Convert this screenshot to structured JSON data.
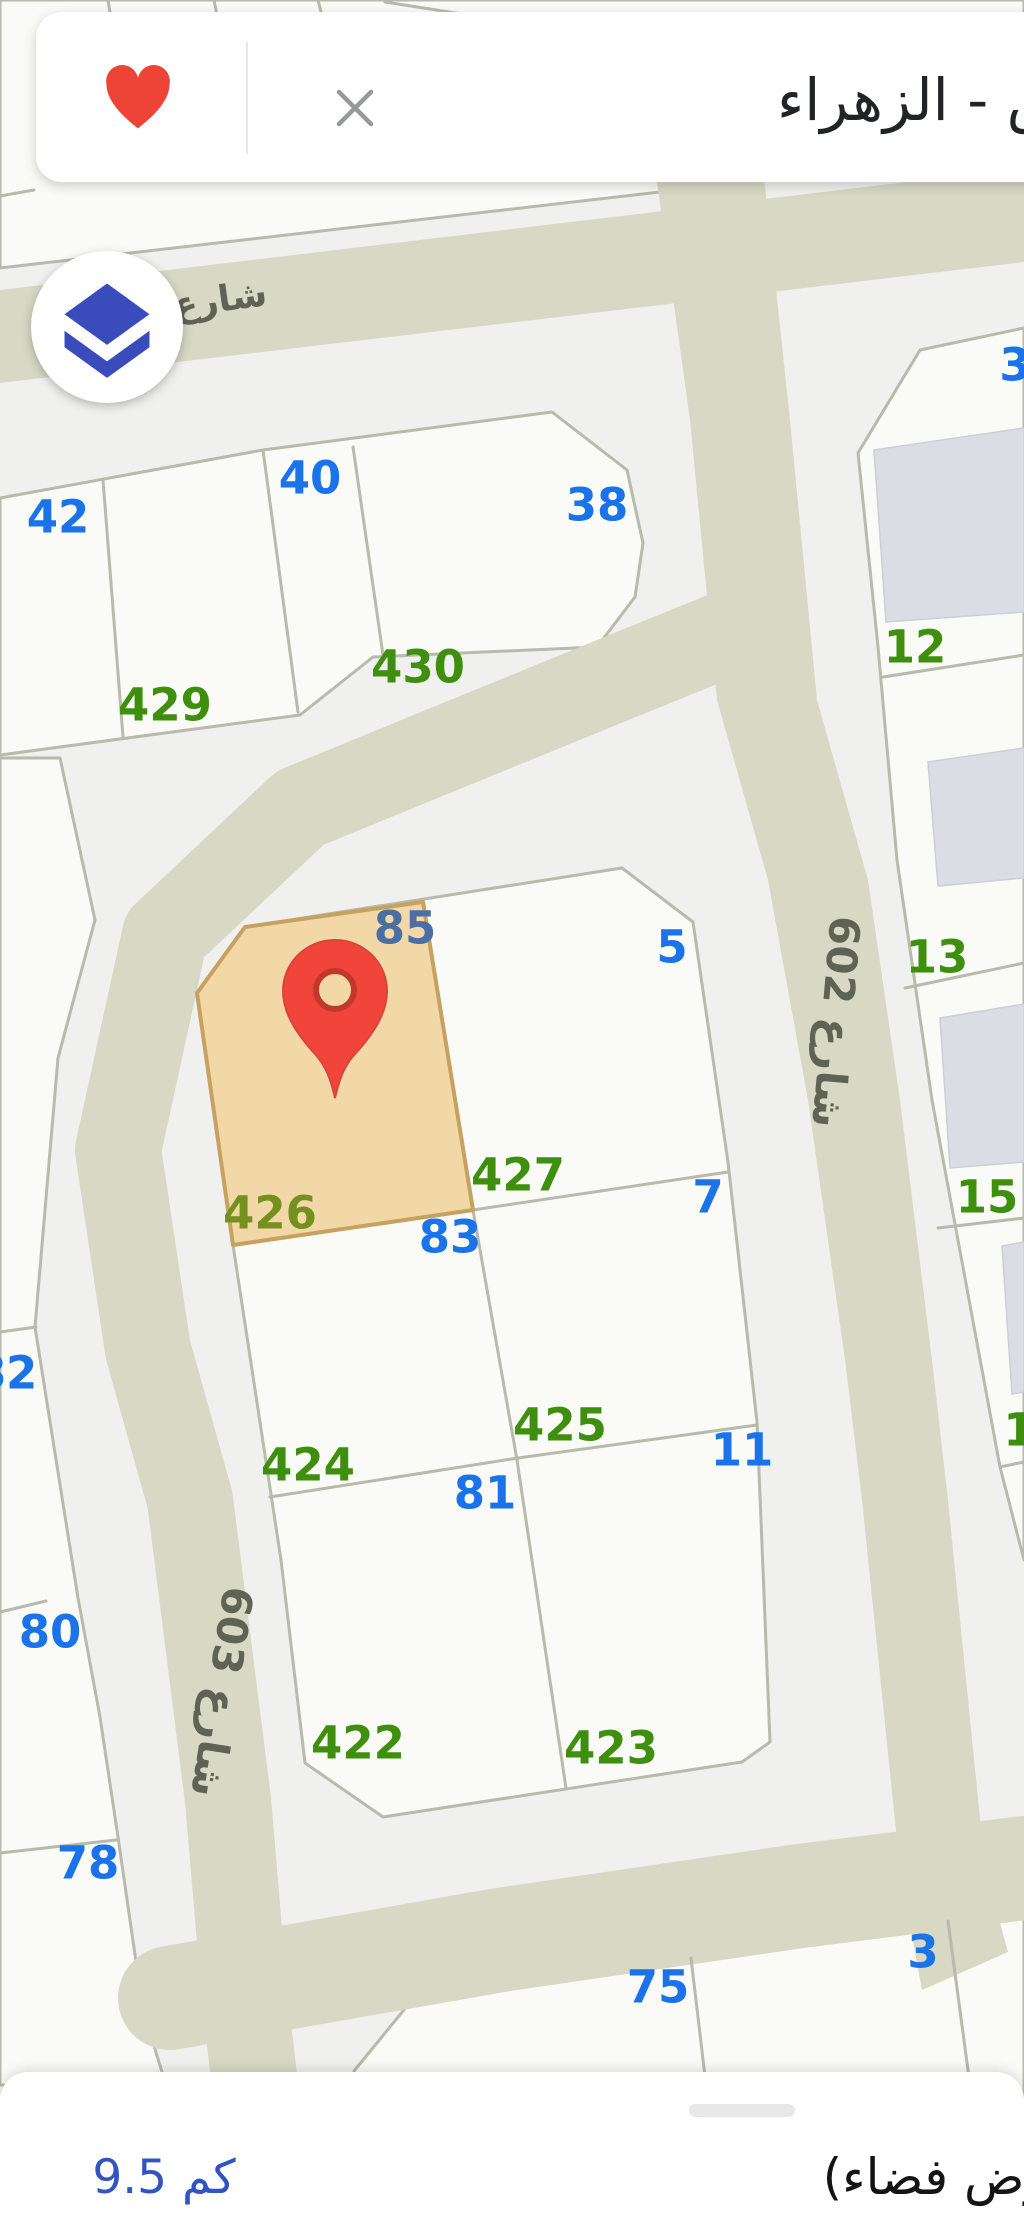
{
  "header": {
    "title_full": "الرياض - الزهراء",
    "title_visible": "- الزهراء",
    "favorite_icon": "heart-icon",
    "close_icon": "x-icon"
  },
  "controls": {
    "layers_icon": "layers-icon"
  },
  "sheet": {
    "distance": "9.5 كم",
    "note_full": "(أرض فضاء)",
    "note_visible": "ض فضاء)"
  },
  "colors": {
    "bg": "#f0f1ee",
    "parcel": "#fafaf7",
    "parcel_border": "#b7baac",
    "street": "#d7d9c5",
    "street_label": "#5f6354",
    "building": "#dcdde4",
    "building_border": "#cdced6",
    "blue": "#1a73e8",
    "green": "#3f8f0f",
    "muted_blue": "#4a6fa5",
    "muted_green": "#74901f",
    "orange": "#f3d8a7",
    "orange_border": "#c7a160",
    "pin_red": "#f1453b",
    "pin_ring": "#c2392b",
    "heart_red": "#ee4337",
    "close_gray": "#97999e",
    "layers_blue": "#3a4cbb",
    "distance_blue": "#3253c2"
  },
  "map": {
    "street_labels": [
      {
        "text": "شارع",
        "x": 220,
        "y": 300,
        "rot": -8,
        "size": 36
      },
      {
        "text": "شارع 602",
        "x": 836,
        "y": 1022,
        "rot": 95,
        "size": 42
      },
      {
        "text": "شارع 603",
        "x": 222,
        "y": 1692,
        "rot": 99,
        "size": 42
      }
    ],
    "parcel_labels": [
      {
        "t": "42",
        "x": 58,
        "y": 517,
        "c": "blue"
      },
      {
        "t": "40",
        "x": 310,
        "y": 478,
        "c": "blue"
      },
      {
        "t": "38",
        "x": 597,
        "y": 505,
        "c": "blue"
      },
      {
        "t": "3",
        "x": 1015,
        "y": 365,
        "c": "blue"
      },
      {
        "t": "429",
        "x": 165,
        "y": 705,
        "c": "green"
      },
      {
        "t": "430",
        "x": 418,
        "y": 667,
        "c": "green"
      },
      {
        "t": "12",
        "x": 915,
        "y": 647,
        "c": "green"
      },
      {
        "t": "85",
        "x": 405,
        "y": 928,
        "c": "muted_blue"
      },
      {
        "t": "5",
        "x": 672,
        "y": 947,
        "c": "blue"
      },
      {
        "t": "13",
        "x": 937,
        "y": 957,
        "c": "green"
      },
      {
        "t": "427",
        "x": 518,
        "y": 1175,
        "c": "green"
      },
      {
        "t": "7",
        "x": 708,
        "y": 1197,
        "c": "blue"
      },
      {
        "t": "15",
        "x": 987,
        "y": 1197,
        "c": "green"
      },
      {
        "t": "426",
        "x": 270,
        "y": 1213,
        "c": "muted_green"
      },
      {
        "t": "83",
        "x": 450,
        "y": 1237,
        "c": "blue"
      },
      {
        "t": "82",
        "x": 6,
        "y": 1373,
        "c": "blue"
      },
      {
        "t": "425",
        "x": 560,
        "y": 1425,
        "c": "green"
      },
      {
        "t": "1",
        "x": 1019,
        "y": 1430,
        "c": "green"
      },
      {
        "t": "11",
        "x": 742,
        "y": 1450,
        "c": "blue"
      },
      {
        "t": "424",
        "x": 308,
        "y": 1465,
        "c": "green"
      },
      {
        "t": "81",
        "x": 485,
        "y": 1493,
        "c": "blue"
      },
      {
        "t": "80",
        "x": 50,
        "y": 1632,
        "c": "blue"
      },
      {
        "t": "422",
        "x": 358,
        "y": 1743,
        "c": "green"
      },
      {
        "t": "423",
        "x": 611,
        "y": 1748,
        "c": "green"
      },
      {
        "t": "78",
        "x": 88,
        "y": 1863,
        "c": "blue"
      },
      {
        "t": "3",
        "x": 923,
        "y": 1952,
        "c": "blue"
      },
      {
        "t": "75",
        "x": 658,
        "y": 1987,
        "c": "blue"
      }
    ],
    "pin": {
      "x": 335,
      "y": 992
    }
  }
}
